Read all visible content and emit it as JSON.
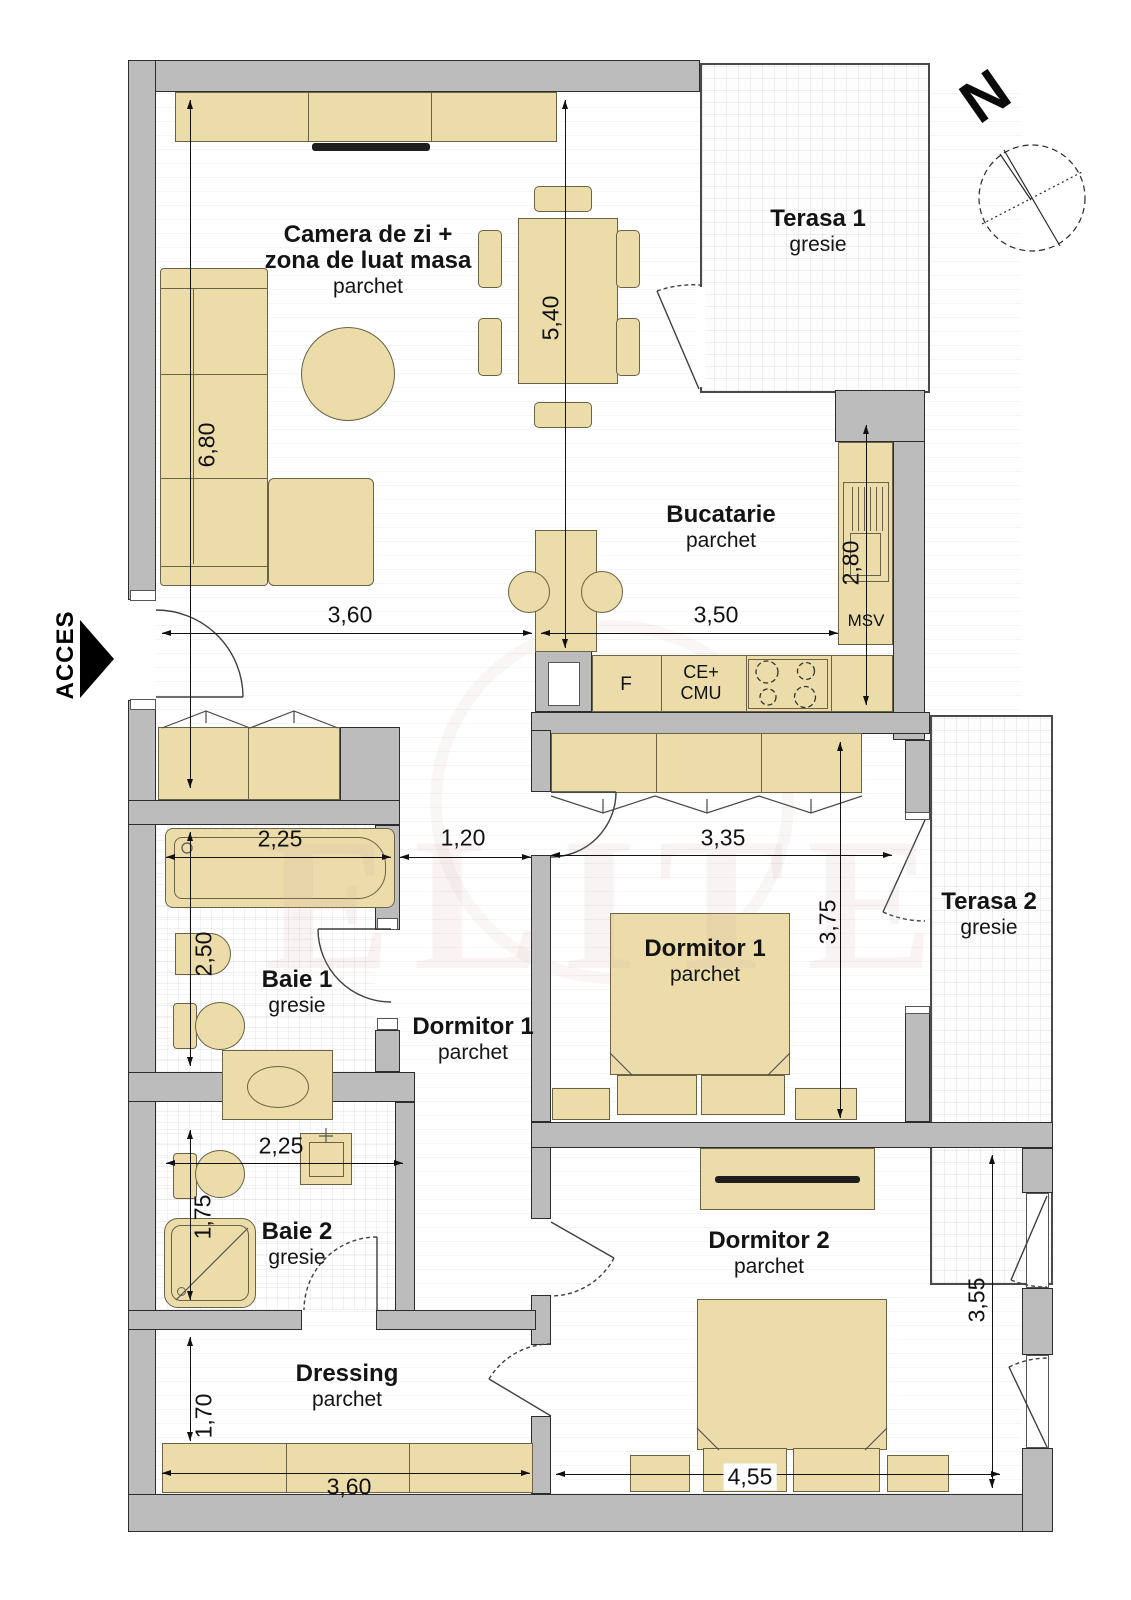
{
  "plan": {
    "rooms": {
      "living": {
        "name_line1": "Camera de zi +",
        "name_line2": "zona de luat masa",
        "floor": "parchet"
      },
      "terasa1": {
        "name": "Terasa 1",
        "floor": "gresie"
      },
      "kitchen": {
        "name": "Bucatarie",
        "floor": "parchet"
      },
      "baie1": {
        "name": "Baie 1",
        "floor": "gresie"
      },
      "hall": {
        "name": "Dormitor 1",
        "floor": "parchet"
      },
      "dormitor1": {
        "name": "Dormitor 1",
        "floor": "parchet"
      },
      "terasa2": {
        "name": "Terasa 2",
        "floor": "gresie"
      },
      "baie2": {
        "name": "Baie 2",
        "floor": "gresie"
      },
      "dressing": {
        "name": "Dressing",
        "floor": "parchet"
      },
      "dormitor2": {
        "name": "Dormitor 2",
        "floor": "parchet"
      }
    },
    "dimensions": {
      "living_width": "3,60",
      "living_height": "6,80",
      "dining_height": "5,40",
      "kitchen_width": "3,50",
      "kitchen_height": "2,80",
      "baie1_width": "2,25",
      "baie1_height": "2,50",
      "hall_width": "1,20",
      "dormitor1_width": "3,35",
      "dormitor1_height": "3,75",
      "baie2_width": "2,25",
      "baie2_height": "1,75",
      "dressing_height": "1,70",
      "dressing_width": "3,60",
      "dormitor2_width": "4,55",
      "dormitor2_height": "3,55"
    },
    "kitchen_labels": {
      "sink": "MSV",
      "fridge": "F",
      "hob_line1": "CE+",
      "hob_line2": "CMU"
    },
    "entrance_label": "ACCES",
    "compass_label": "N",
    "watermark": "ELITE",
    "colors": {
      "wall": "#bcbcbc",
      "furniture": "#ebdcaa",
      "dimension": "#111111"
    }
  }
}
